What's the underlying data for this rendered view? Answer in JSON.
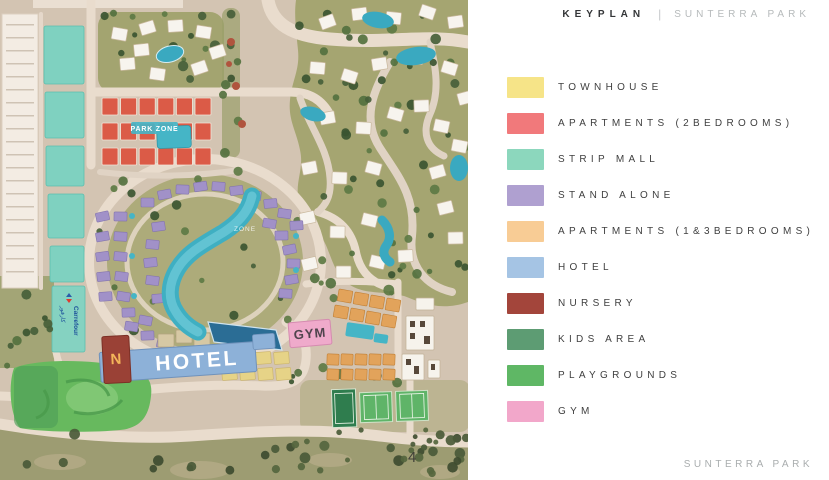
{
  "header": {
    "title": "KEYPLAN",
    "separator": "|",
    "project": "SUNTERRA PARK"
  },
  "legend": {
    "items": [
      {
        "key": "townhouse",
        "label": "TOWNHOUSE",
        "color": "#F6E488"
      },
      {
        "key": "apartments-2bedrooms",
        "label": "APARTMENTS (2BEDROOMS)",
        "color": "#F1797B"
      },
      {
        "key": "strip-mall",
        "label": "STRIP MALL",
        "color": "#8CD7BD"
      },
      {
        "key": "stand-alone",
        "label": "STAND ALONE",
        "color": "#AFA0D0"
      },
      {
        "key": "apartments-1-3bedrooms",
        "label": "APARTMENTS (1&3BEDROOMS)",
        "color": "#F8CC95"
      },
      {
        "key": "hotel",
        "label": "HOTEL",
        "color": "#A5C4E4"
      },
      {
        "key": "nursery",
        "label": "NURSERY",
        "color": "#A3453B"
      },
      {
        "key": "kids-area",
        "label": "KIDS AREA",
        "color": "#5D9C73"
      },
      {
        "key": "playgrounds",
        "label": "PLAYGROUNDS",
        "color": "#5FB765"
      },
      {
        "key": "gym",
        "label": "GYM",
        "color": "#F2A7CA"
      }
    ]
  },
  "map": {
    "labels": {
      "hotel": "HOTEL",
      "gym": "GYM",
      "nursery": "N",
      "carrefour": "Carrefour",
      "carrefour_ar": "كارفور",
      "zone_red_cluster": "PARK ZONE",
      "zone_lagoon": "ZONE",
      "page_number": "4"
    }
  },
  "footer": {
    "project": "SUNTERRA PARK"
  }
}
